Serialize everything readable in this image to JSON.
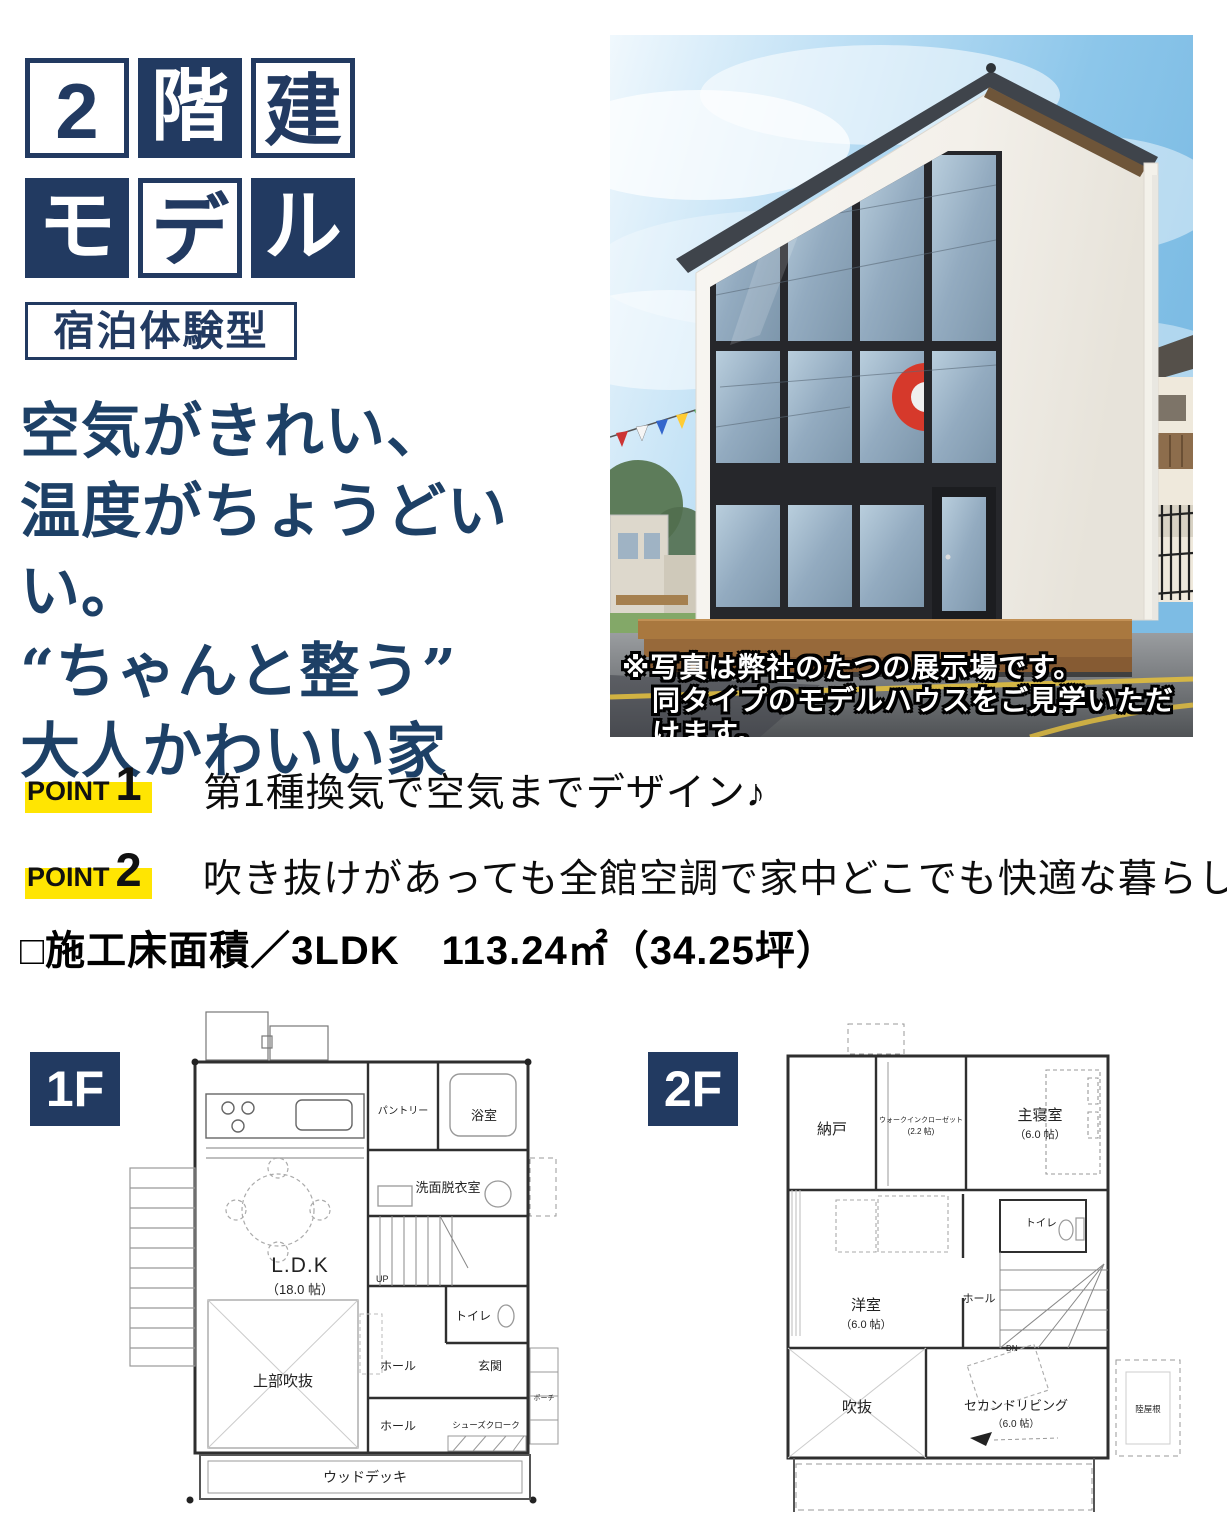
{
  "colors": {
    "navy": "#223a61",
    "headline_navy": "#1d4066",
    "highlight_yellow": "#ffe502",
    "red_logo": "#d6392b"
  },
  "title": {
    "boxes": [
      {
        "char": "2",
        "variant": "outline"
      },
      {
        "char": "階",
        "variant": "fill"
      },
      {
        "char": "建",
        "variant": "outline"
      },
      {
        "char": "モ",
        "variant": "fill"
      },
      {
        "char": "デ",
        "variant": "outline"
      },
      {
        "char": "ル",
        "variant": "fill"
      }
    ],
    "subtitle": "宿泊体験型"
  },
  "headline": {
    "lines": [
      "空気がきれい、",
      "温度がちょうどいい。",
      "“ちゃんと整う”",
      "大人かわいい家"
    ]
  },
  "photo": {
    "caption_line1": "※写真は弊社のたつの展示場です。",
    "caption_line2": "同タイプのモデルハウスをご見学いただけます。"
  },
  "points": [
    {
      "label": "POINT",
      "number": "1",
      "text": "第1種換気で空気までデザイン♪"
    },
    {
      "label": "POINT",
      "number": "2",
      "text": "吹き抜けがあっても全館空調で家中どこでも快適な暮らし"
    }
  ],
  "floor_area": {
    "label": "□施工床面積／3LDK",
    "value": "113.24㎡（34.25坪）"
  },
  "floorplans": {
    "f1": {
      "tag": "1F",
      "ldk": "L.D.K",
      "ldk_size": "（18.0 帖）",
      "void_above": "上部吹抜",
      "pantry": "パントリー",
      "bath": "浴室",
      "washroom": "洗面脱衣室",
      "toilet": "トイレ",
      "hall_upper": "ホール",
      "entrance": "玄関",
      "hall_lower": "ホール",
      "shoes_closet": "シューズクローク",
      "wood_deck": "ウッドデッキ",
      "porch": "ポーチ",
      "up": "UP"
    },
    "f2": {
      "tag": "2F",
      "storage": "納戸",
      "wic": "ウォークインクローゼット",
      "wic_size": "(2.2 帖)",
      "master": "主寝室",
      "master_size": "（6.0 帖）",
      "toilet": "トイレ",
      "western_room": "洋室",
      "western_size": "（6.0 帖）",
      "hall": "ホール",
      "void": "吹抜",
      "second_living": "セカンドリビング",
      "second_living_size": "（6.0 帖）",
      "flat_roof": "陸屋根",
      "dn": "DN"
    }
  }
}
